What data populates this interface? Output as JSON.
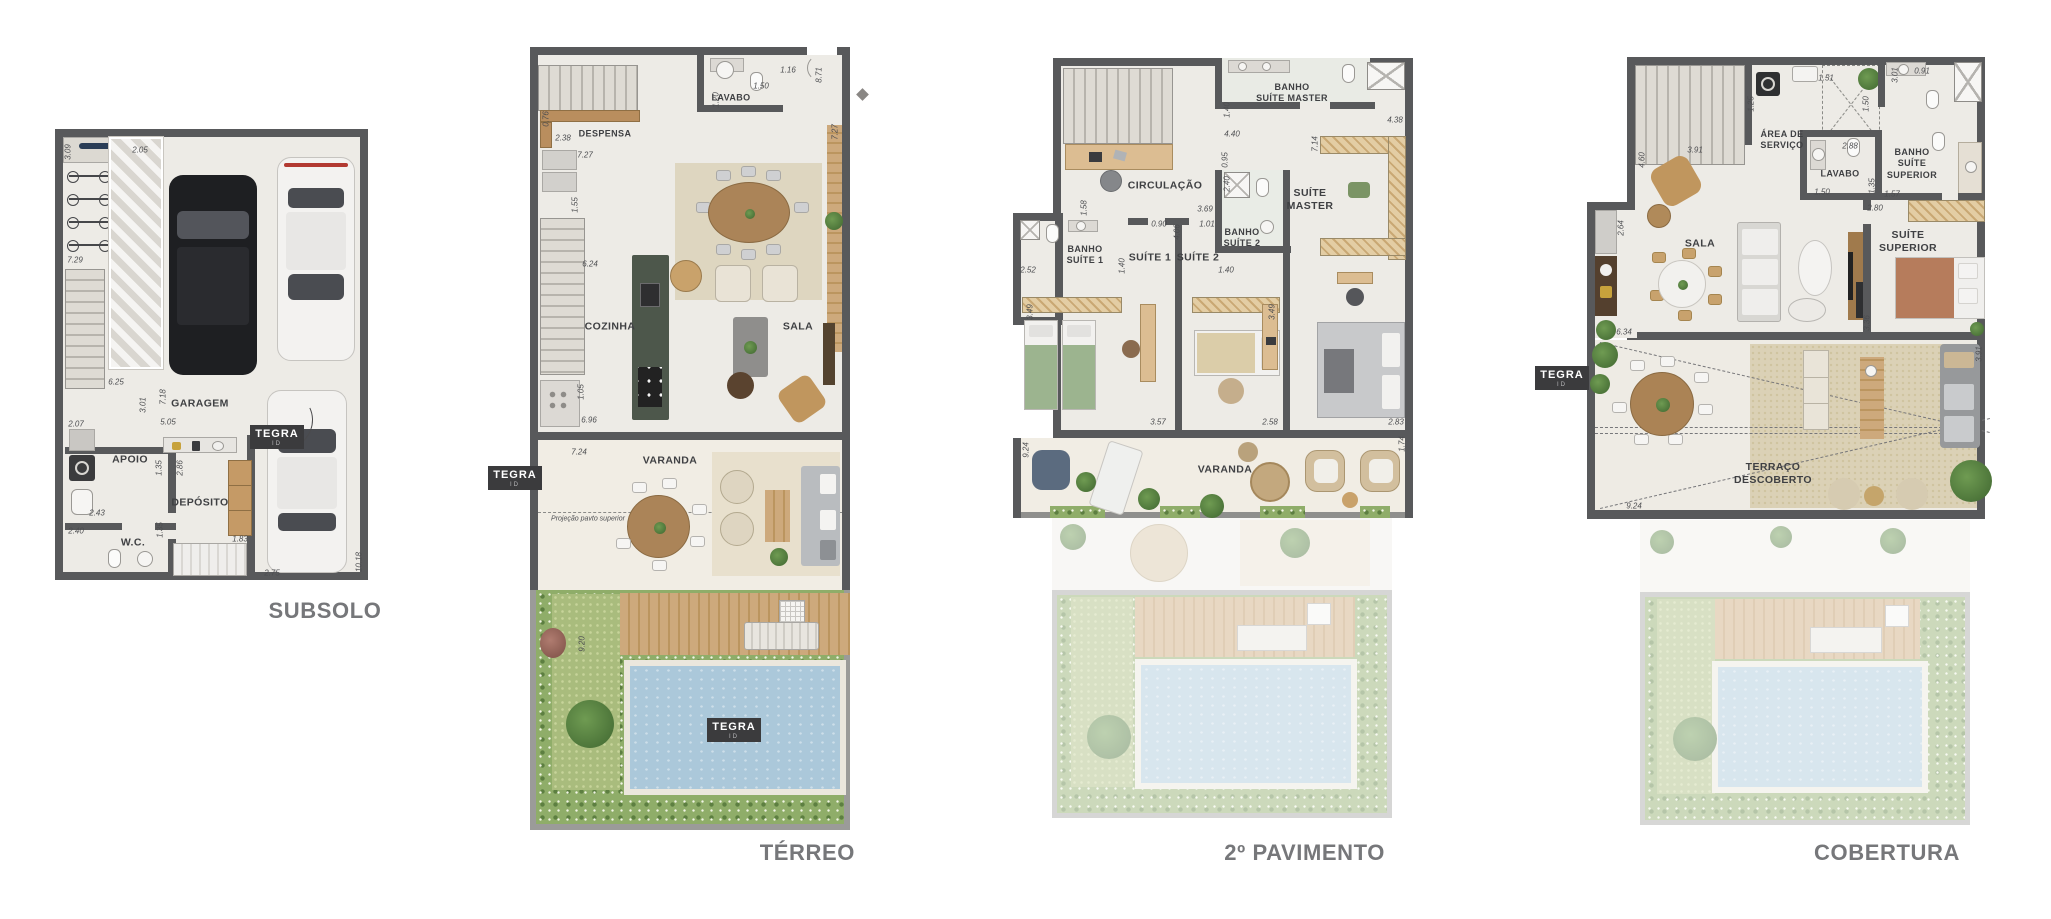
{
  "titles": {
    "subsolo": "SUBSOLO",
    "terreo": "TÉRREO",
    "pav2": "2º PAVIMENTO",
    "cobertura": "COBERTURA"
  },
  "logo": {
    "brand": "TEGRA",
    "sub": "ID"
  },
  "subsolo": {
    "rooms": {
      "garagem": "GARAGEM",
      "apoio": "APOIO",
      "deposito": "DEPÓSITO",
      "wc": "W.C."
    },
    "dims": [
      "3.09",
      "2.05",
      "7.29",
      "6.25",
      "3.01",
      "7.18",
      "5.05",
      "2.07",
      "1.35",
      "2.86",
      "2.43",
      "2.40",
      "1.35",
      "1.83",
      "2.75",
      "10.18"
    ]
  },
  "terreo": {
    "rooms": {
      "despensa": "DESPENSA",
      "lavabo": "LAVABO",
      "cozinha": "COZINHA",
      "sala": "SALA",
      "varanda": "VARANDA"
    },
    "note": "Projeção pavto superior",
    "dims": [
      "0.76",
      "2.38",
      "7.27",
      "1.20",
      "1.50",
      "1.16",
      "8.71",
      "7.27",
      "1.55",
      "6.24",
      "1.05",
      "6.96",
      "7.24",
      "9.20"
    ]
  },
  "pav2": {
    "rooms": {
      "banho_master": "BANHO\nSUÍTE MASTER",
      "circulacao": "CIRCULAÇÃO",
      "suite_master": "SUÍTE\nMASTER",
      "banho1": "BANHO\nSUÍTE 1",
      "suite1": "SUÍTE 1",
      "suite2": "SUÍTE 2",
      "banho2": "BANHO\nSUÍTE 2",
      "varanda": "VARANDA"
    },
    "dims": [
      "1.40",
      "4.38",
      "4.40",
      "7.14",
      "0.95",
      "2.40",
      "1.58",
      "3.69",
      "0.90",
      "4.06",
      "1.01",
      "2.52",
      "1.40",
      "1.40",
      "3.49",
      "3.49",
      "3.57",
      "2.58",
      "2.83",
      "9.24",
      "1.74"
    ]
  },
  "cobertura": {
    "rooms": {
      "area_servico": "ÁREA DE\nSERVIÇO",
      "lavabo": "LAVABO",
      "banho_superior": "BANHO\nSUÍTE\nSUPERIOR",
      "sala": "SALA",
      "suite_superior": "SUÍTE\nSUPERIOR",
      "terraco": "TERRAÇO\nDESCOBERTO"
    },
    "dims": [
      "1.25",
      "1.51",
      "1.50",
      "3.01",
      "0.91",
      "2.88",
      "3.91",
      "4.60",
      "1.50",
      "1.35",
      "1.57",
      "2.80",
      "2.64",
      "6.34",
      "3.36",
      "3.91",
      "9.24"
    ]
  }
}
